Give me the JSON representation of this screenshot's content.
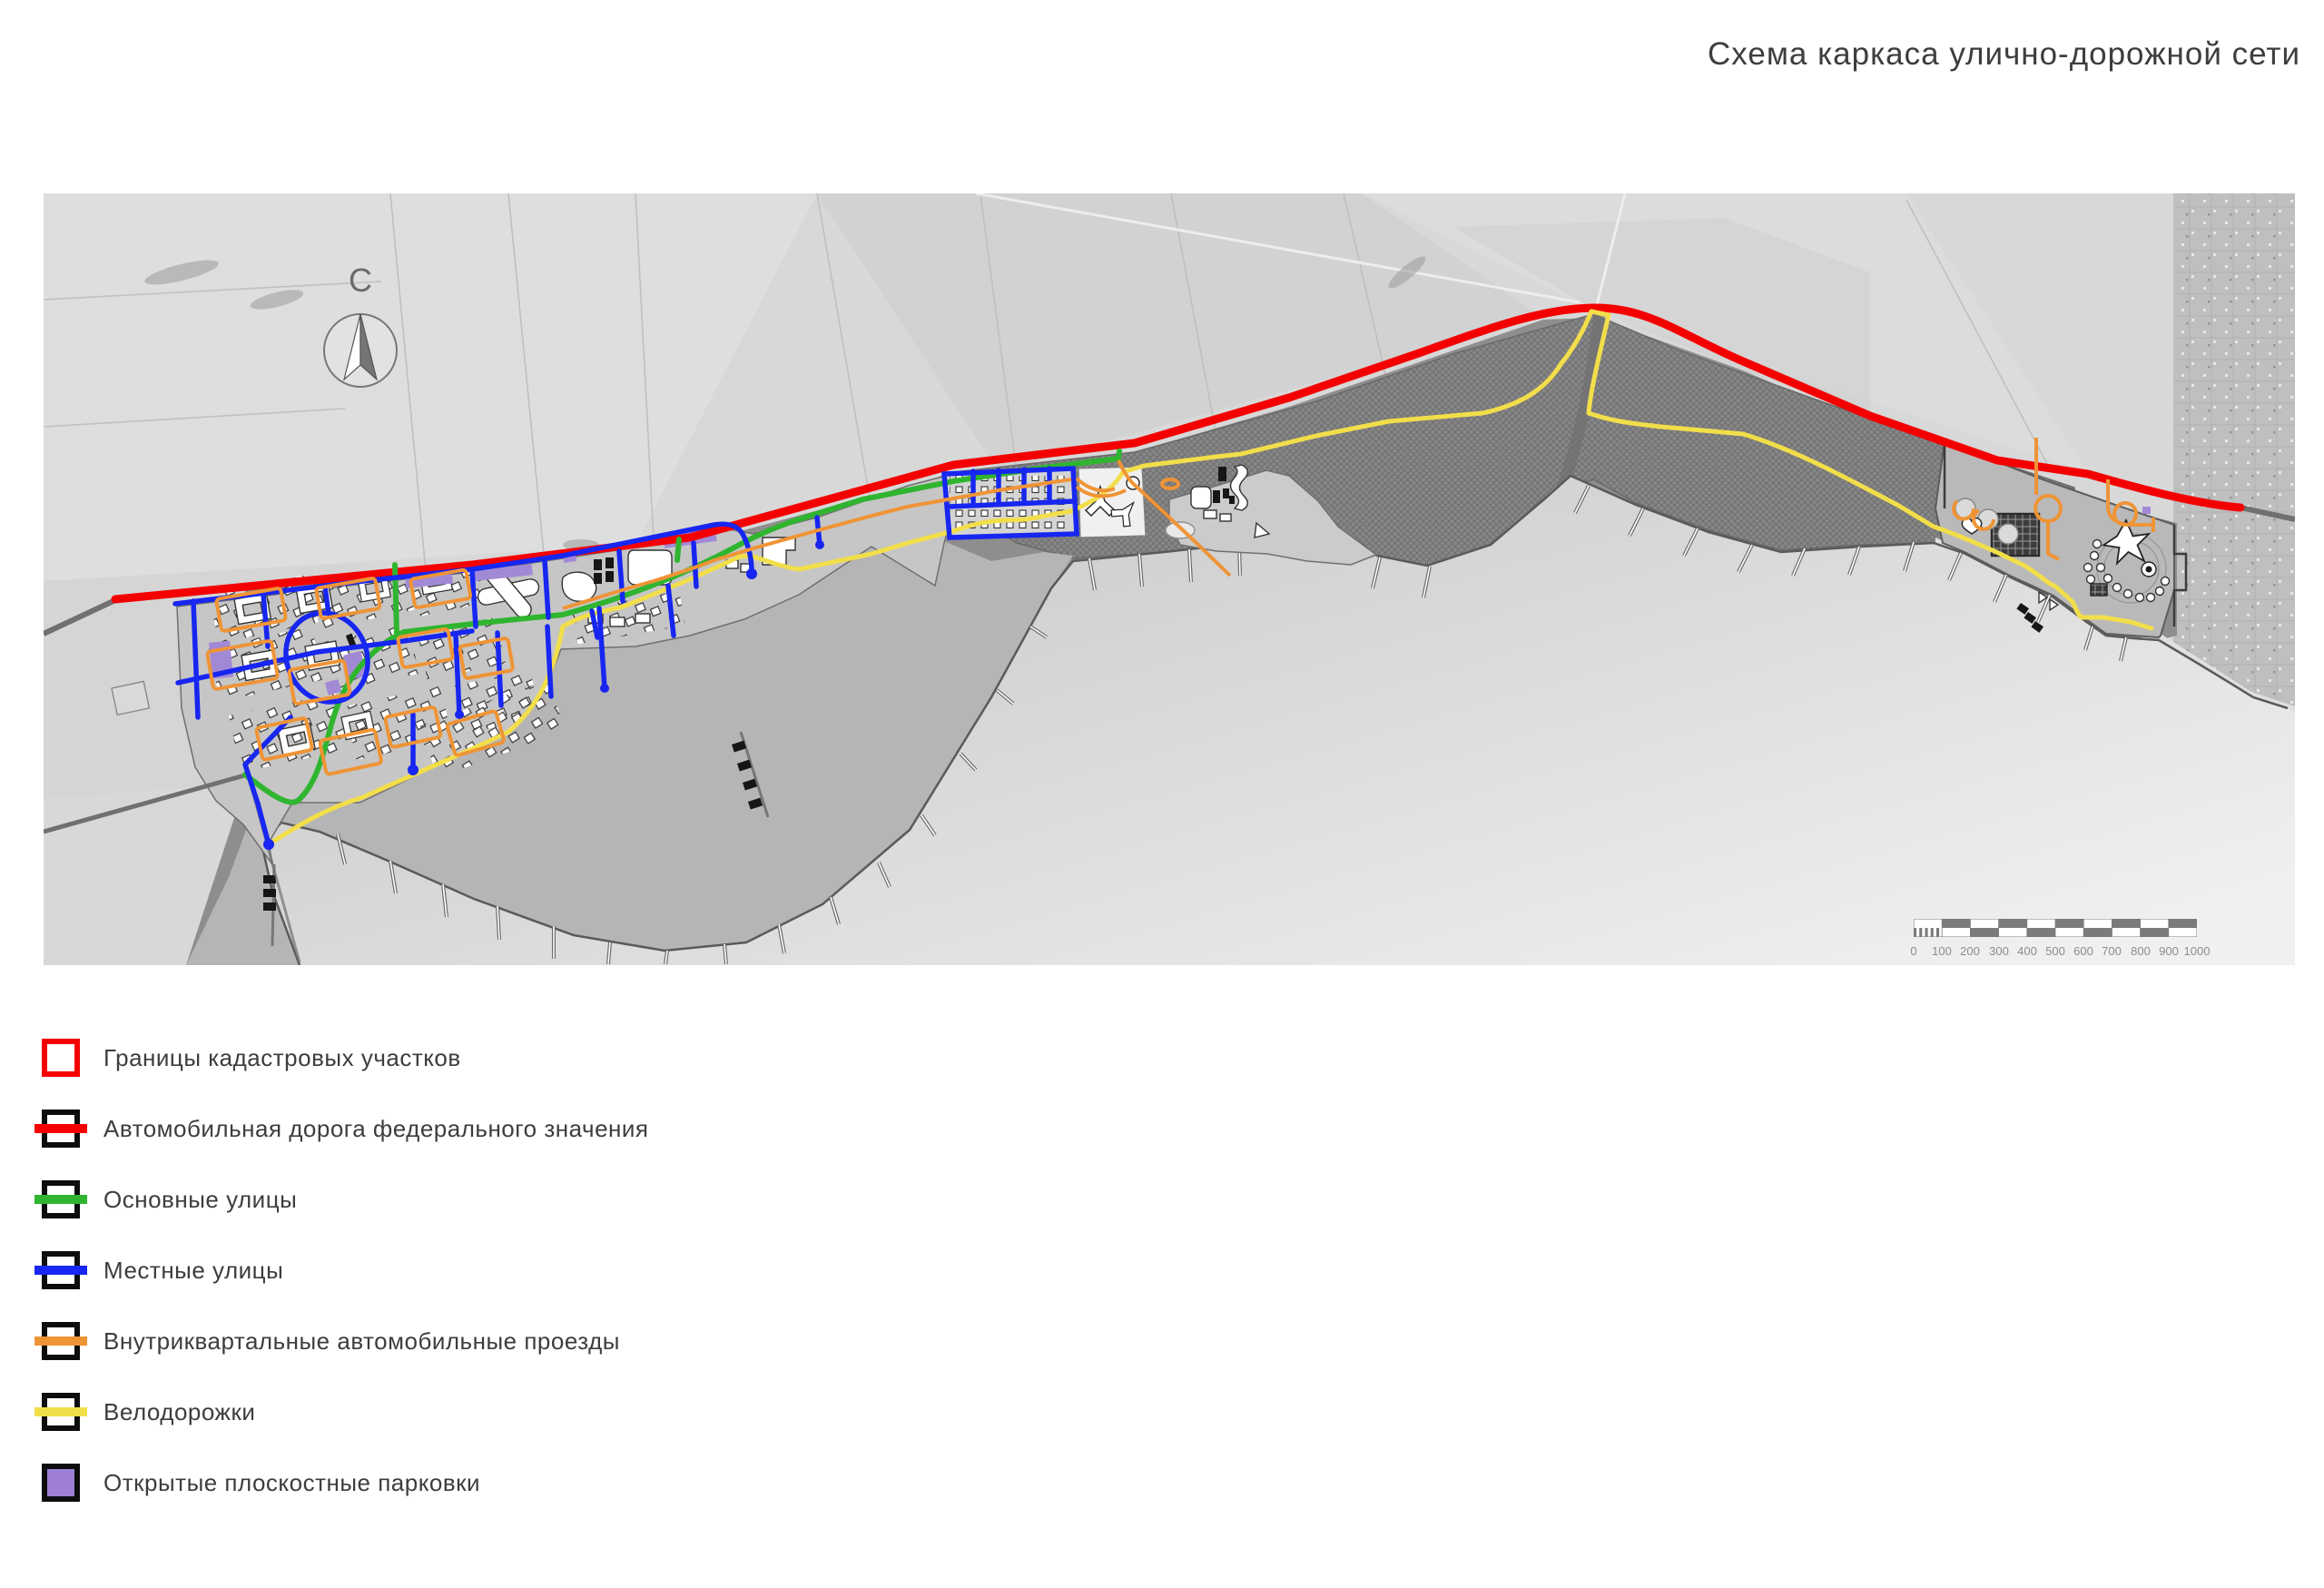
{
  "title": "Схема каркаса улично-дорожной сети",
  "compass": {
    "label": "С"
  },
  "legend": {
    "items": [
      {
        "label": "Границы кадастровых участков",
        "color": "#f40000",
        "type": "outline"
      },
      {
        "label": "Автомобильная дорога федерального значения",
        "color": "#f40000",
        "type": "line"
      },
      {
        "label": "Основные улицы",
        "color": "#2fb52f",
        "type": "line"
      },
      {
        "label": "Местные улицы",
        "color": "#1726f0",
        "type": "line"
      },
      {
        "label": "Внутриквартальные автомобильные проезды",
        "color": "#ef9436",
        "type": "line"
      },
      {
        "label": "Велодорожки",
        "color": "#f2de4a",
        "type": "line"
      },
      {
        "label": "Открытые плоскостные парковки",
        "color": "#9d7fd6",
        "type": "fill"
      }
    ]
  },
  "scale_bar": {
    "labels": [
      "0",
      "100",
      "200",
      "300",
      "400",
      "500",
      "600",
      "700",
      "800",
      "900",
      "1000"
    ]
  },
  "map_colors": {
    "federal_road": "#f40000",
    "main_streets": "#2fb52f",
    "local_streets": "#1726f0",
    "driveways": "#ef9436",
    "bike_paths": "#f2de4a",
    "parking": "#a289d6"
  }
}
